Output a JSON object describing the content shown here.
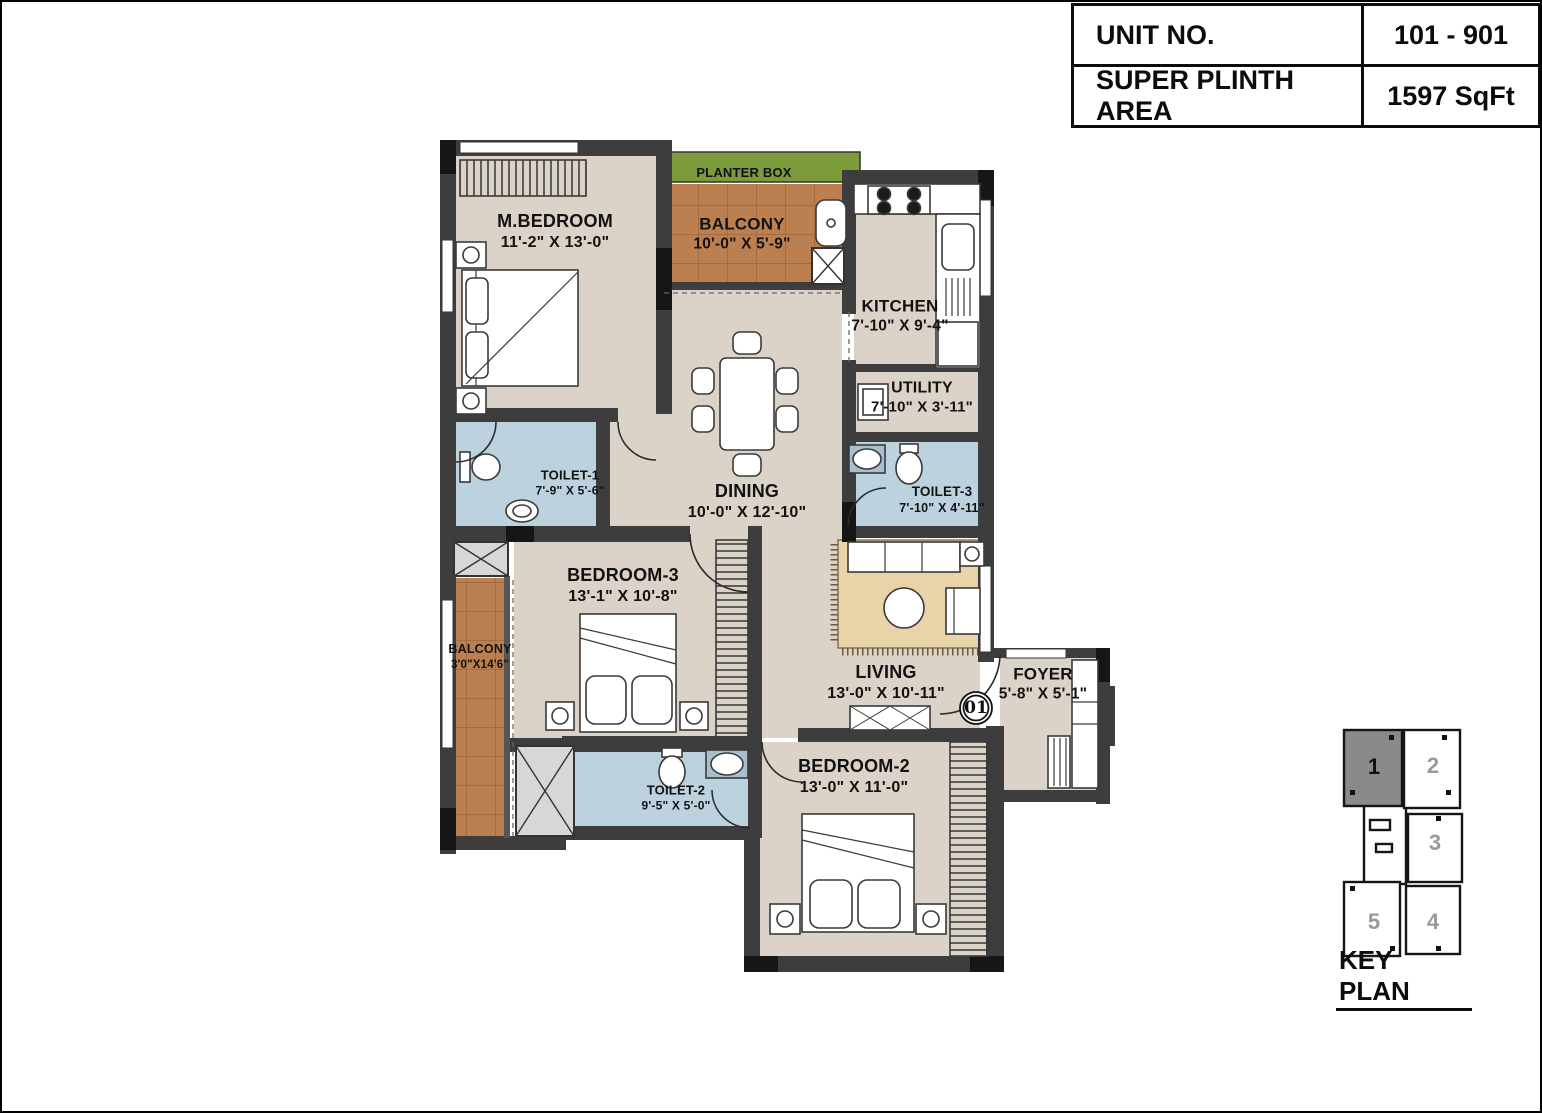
{
  "info_table": {
    "rows": [
      {
        "label": "UNIT NO.",
        "value": "101 - 901"
      },
      {
        "label": "SUPER PLINTH AREA",
        "value": "1597 SqFt"
      }
    ]
  },
  "floor_plan": {
    "unit_marker": "01",
    "rooms": [
      {
        "id": "m_bedroom",
        "name": "M.BEDROOM",
        "dims": "11'-2\" X 13'-0\""
      },
      {
        "id": "planter_box",
        "name": "PLANTER BOX",
        "dims": ""
      },
      {
        "id": "balcony_top",
        "name": "BALCONY",
        "dims": "10'-0\" X 5'-9\""
      },
      {
        "id": "kitchen",
        "name": "KITCHEN",
        "dims": "7'-10\" X 9'-4\""
      },
      {
        "id": "utility",
        "name": "UTILITY",
        "dims": "7'-10\" X 3'-11\""
      },
      {
        "id": "toilet_1",
        "name": "TOILET-1",
        "dims": "7'-9\" X 5'-6\""
      },
      {
        "id": "toilet_3",
        "name": "TOILET-3",
        "dims": "7'-10\" X 4'-11\""
      },
      {
        "id": "dining",
        "name": "DINING",
        "dims": "10'-0\" X 12'-10\""
      },
      {
        "id": "bedroom_3",
        "name": "BEDROOM-3",
        "dims": "13'-1\" X 10'-8\""
      },
      {
        "id": "balcony_left",
        "name": "BALCONY",
        "dims": "3'0\"X14'6\""
      },
      {
        "id": "living",
        "name": "LIVING",
        "dims": "13'-0\" X 10'-11\""
      },
      {
        "id": "foyer",
        "name": "FOYER",
        "dims": "5'-8\" X 5'-1\""
      },
      {
        "id": "toilet_2",
        "name": "TOILET-2",
        "dims": "9'-5\" X 5'-0\""
      },
      {
        "id": "bedroom_2",
        "name": "BEDROOM-2",
        "dims": "13'-0\" X 11'-0\""
      }
    ]
  },
  "key_plan": {
    "title": "KEY PLAN",
    "highlighted_unit": "1",
    "units": [
      {
        "label": "1"
      },
      {
        "label": "2"
      },
      {
        "label": "3"
      },
      {
        "label": "4"
      },
      {
        "label": "5"
      }
    ]
  },
  "colors": {
    "wall": "#3d3d3d",
    "floor": "#dbd3c7",
    "toilet": "#bcd2de",
    "balcony": "#bc8050",
    "planter": "#7c9b3b",
    "rug": "#e9d3a9",
    "keyplan_highlight": "#8a8a8a"
  }
}
